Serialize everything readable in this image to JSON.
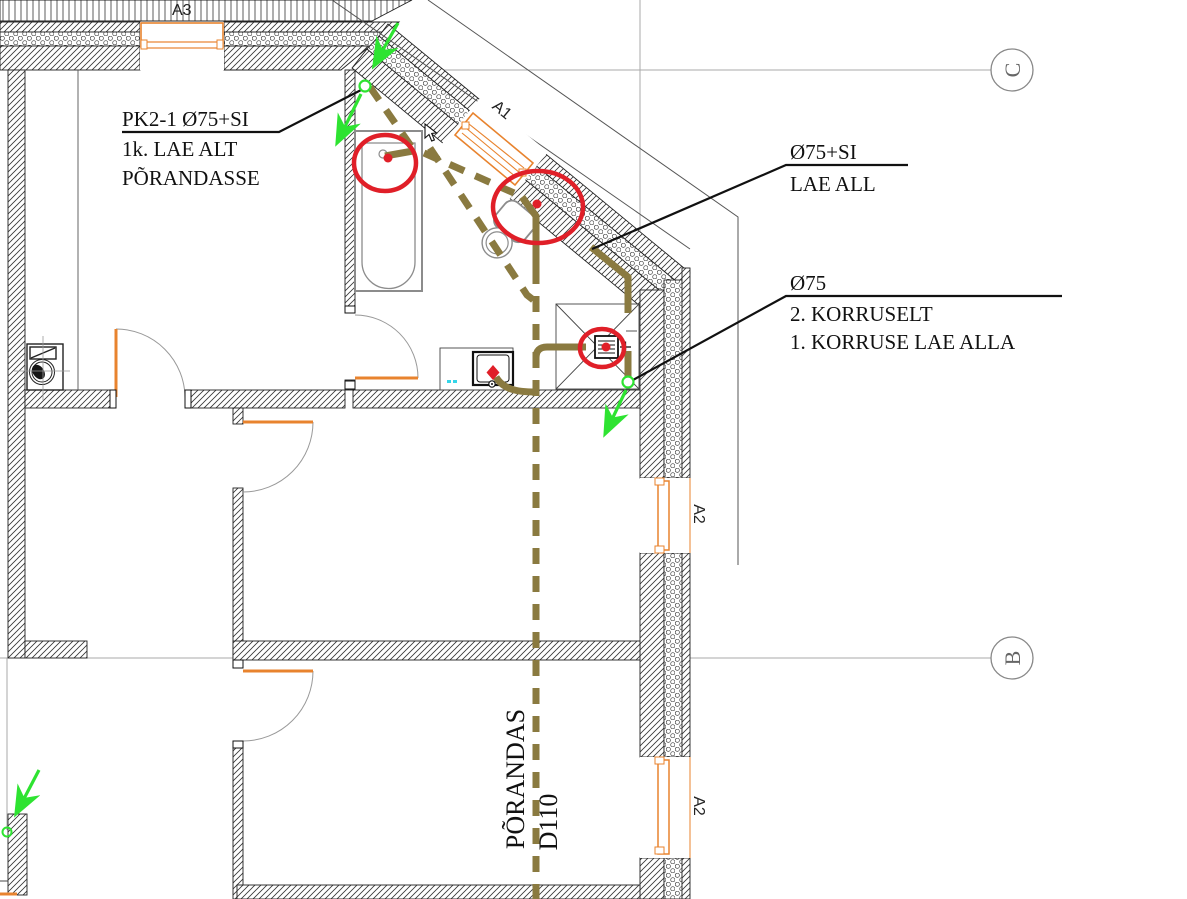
{
  "drawing": {
    "title": "plumbing-floor-plan",
    "annotations": {
      "pk2": {
        "line1": "PK2-1 Ø75+SI",
        "line2": "1k. LAE ALT",
        "line3": "PÕRANDASSE"
      },
      "lae_all": {
        "line1": "Ø75+SI",
        "line2": "LAE ALL"
      },
      "korruselt": {
        "line1": "Ø75",
        "line2": "2. KORRUSELT",
        "line3": "1. KORRUSE LAE ALLA"
      },
      "floor_pipe": {
        "line1": "PÕRANDAS",
        "line2": "D110"
      }
    },
    "window_labels": {
      "a3": "A3",
      "a1": "A1",
      "a2_upper": "A2",
      "a2_lower": "A2"
    },
    "grid_labels": {
      "c": "C",
      "b": "B"
    },
    "colors": {
      "pipe": "#8a7a40",
      "highlight_red": "#e01f28",
      "arrow_green": "#2ee331",
      "window_frame": "#e8832e",
      "fixture_gray": "#8c8c8c"
    }
  }
}
